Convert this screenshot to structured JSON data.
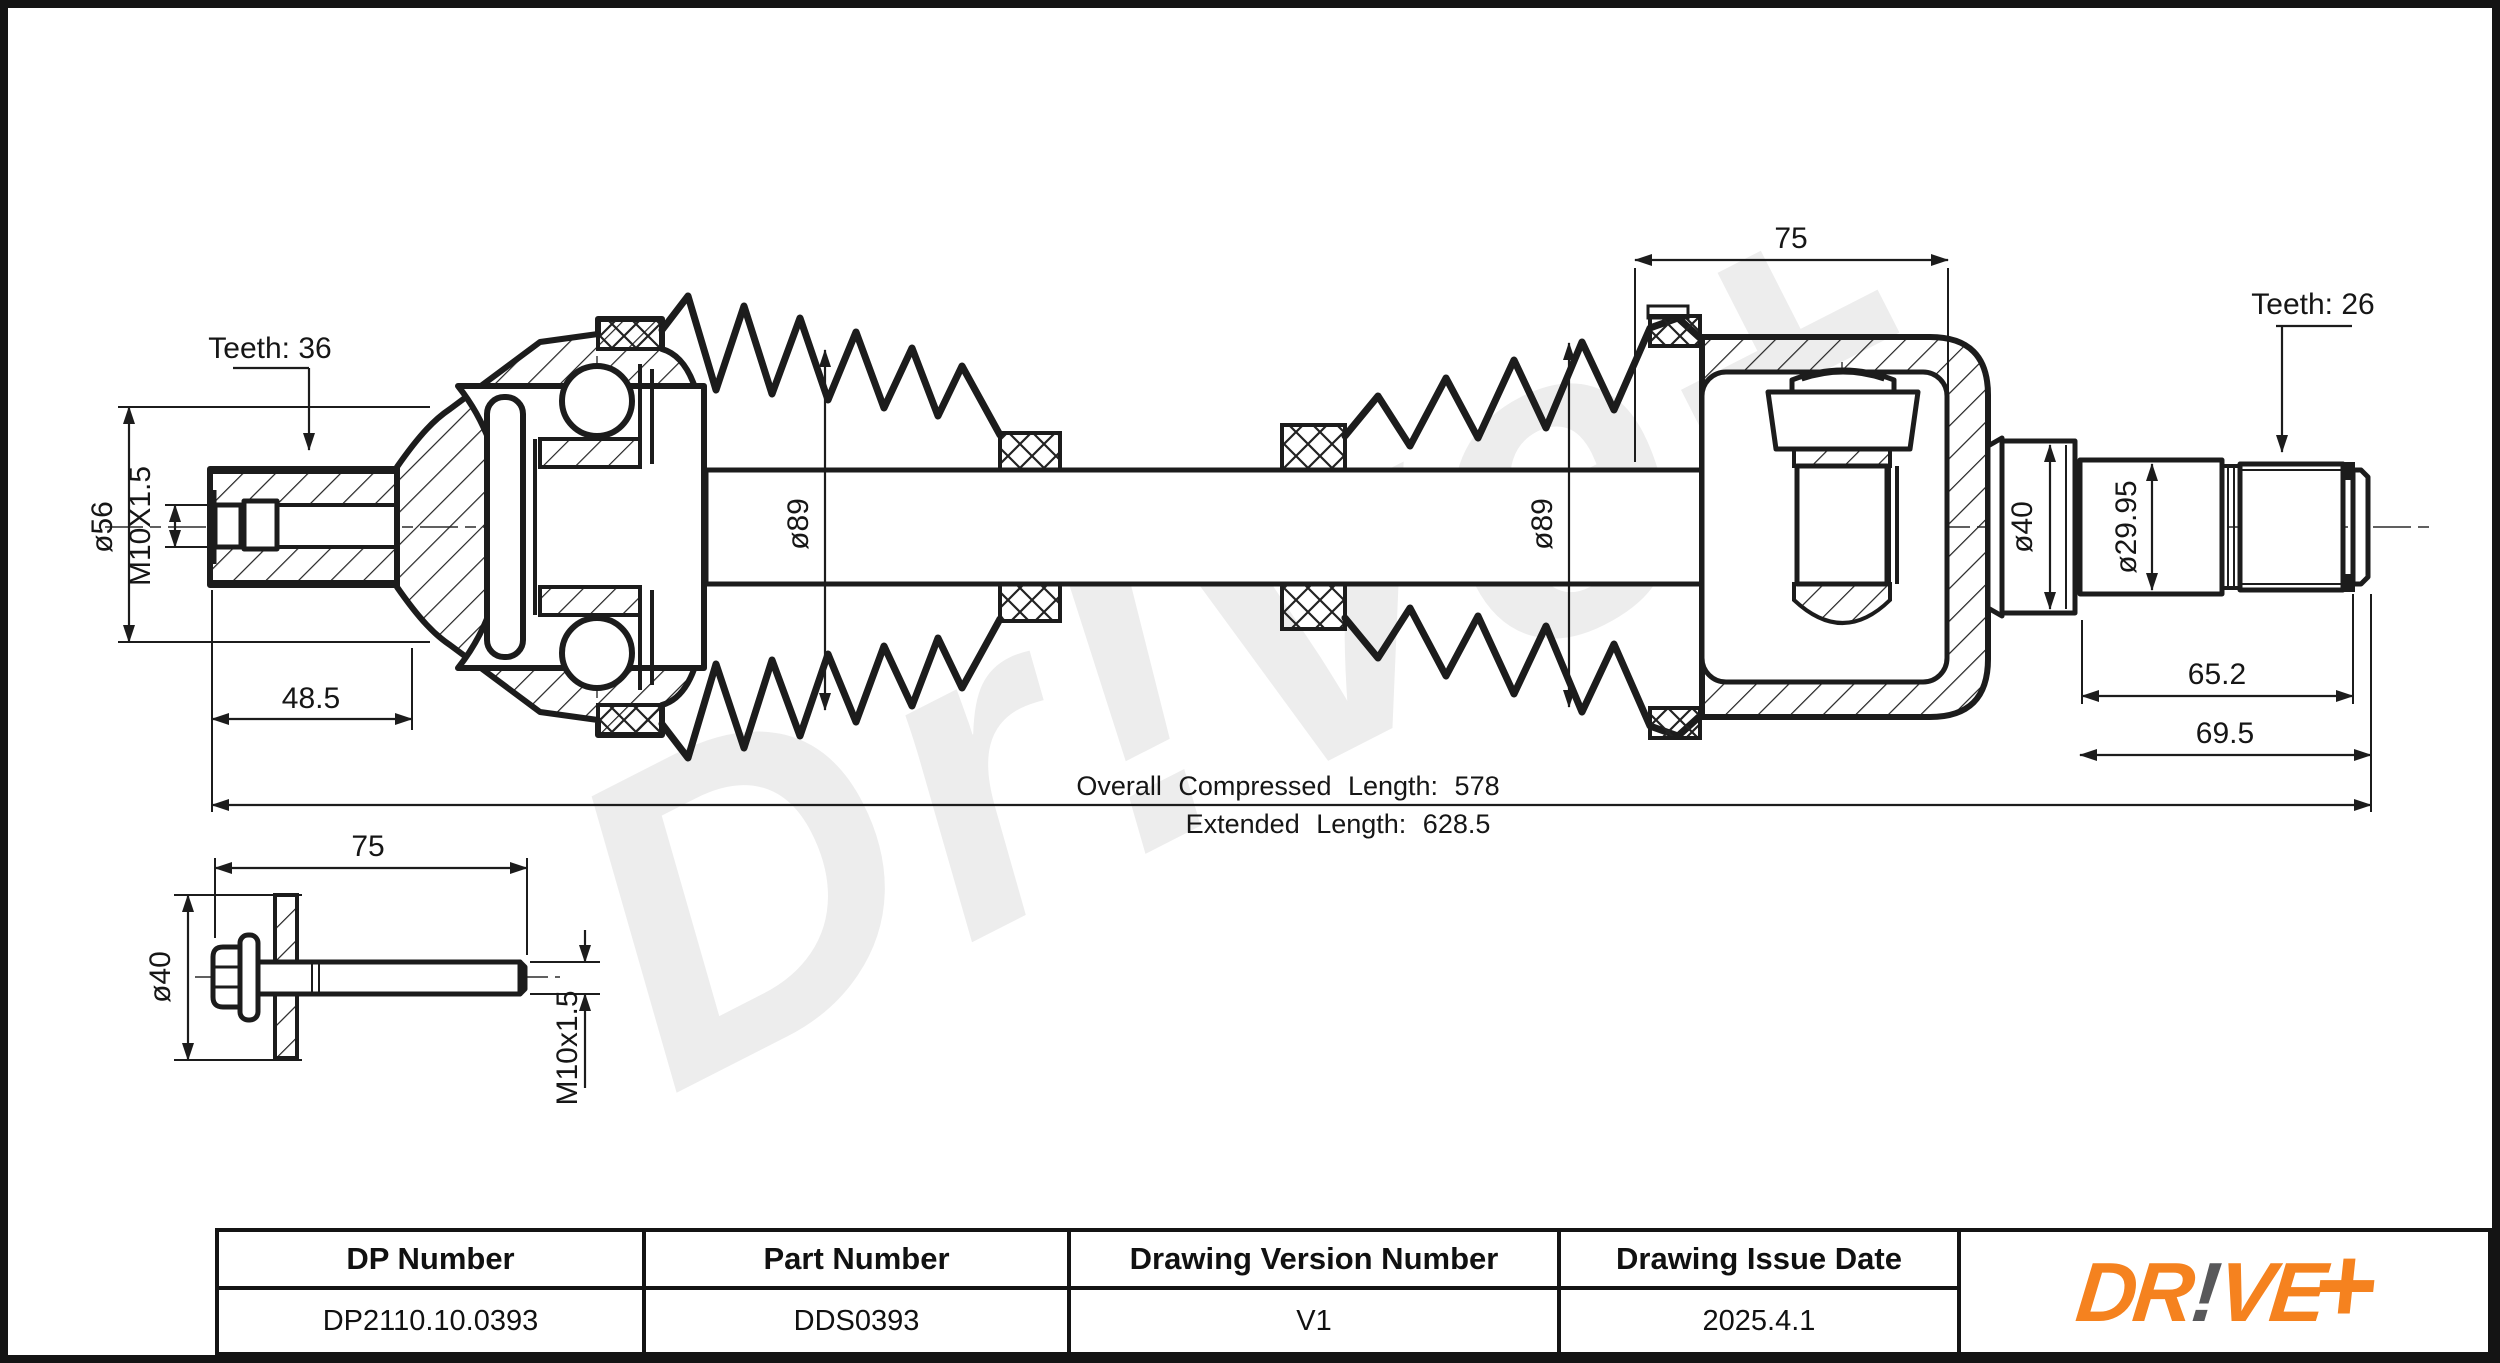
{
  "watermark": {
    "text": "Dr!ve+"
  },
  "labels": {
    "teeth_left": "Teeth: 36",
    "dia56": "ø56",
    "m10_left": "M10X1.5",
    "dim48_5": "48.5",
    "dia89_left": "ø89",
    "dim75_top": "75",
    "dia89_right": "ø89",
    "teeth_right": "Teeth: 26",
    "dia40_right": "ø40",
    "dia29_95": "ø29.95",
    "dim65_2": "65.2",
    "dim69_5": "69.5",
    "overall": "Overall Compressed Length: 578",
    "extended": "Extended Length: 628.5",
    "bolt_75": "75",
    "bolt_dia40": "ø40",
    "bolt_m10": "M10x1.5"
  },
  "table": {
    "columns": [
      {
        "header": "DP Number",
        "value": "DP2110.10.0393"
      },
      {
        "header": "Part Number",
        "value": "DDS0393"
      },
      {
        "header": "Drawing Version Number",
        "value": "V1"
      },
      {
        "header": "Drawing Issue Date",
        "value": "2025.4.1"
      }
    ]
  },
  "logo": {
    "dr": "DR",
    "excl": "!",
    "ve": "VE",
    "plus": "+",
    "orange": "#F5821F",
    "gray": "#58585A"
  }
}
